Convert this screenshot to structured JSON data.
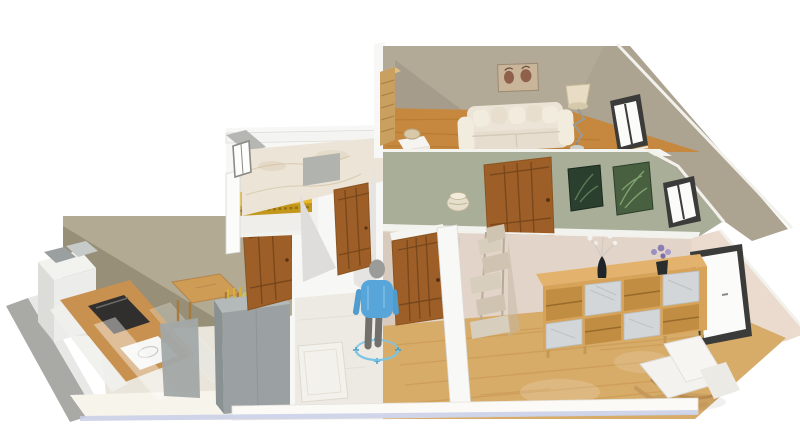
{
  "app": {
    "view": "3d-furnished-floor-plan-render",
    "background": "#ffffff"
  },
  "palette": {
    "lr_wall": "#b3a997",
    "lr_wall_shadow": "#a2988a",
    "right_wall": "#ada391",
    "wood_floor": "#c5883e",
    "wood_streak": "#ad722b",
    "green_wall": "#a8ae97",
    "pink_wall": "#e2d4c8",
    "pink_wall_light": "#eadbce",
    "pink_shadow": "#d6c7ba",
    "oak_floor": "#d7ab68",
    "oak_streak": "#c5944c",
    "door_brown": "#9d5f27",
    "door_line": "#70421a",
    "olive_wall": "#b2aa92",
    "olive_shadow": "#766e59",
    "marble_wall": "#ece4d6",
    "yellow_wall": "#e8b82b",
    "yellow_dark": "#c3961c",
    "gray_cabinet": "#9ba1a2",
    "gray_cabinet_top": "#b4baba",
    "gray_cabinet_side": "#8a9192",
    "counter_wood": "#c89150",
    "oven_dark": "#302f2d",
    "window_frame": "#3b3b39",
    "glass": "#fbfbfa",
    "sofa_cream": "#e6ddcf",
    "sofa_cream_light": "#f2ecdf",
    "sideboard_wood": "#d7a359",
    "sideboard_top": "#e3b26c",
    "marble_panel": "#d2d6d9",
    "cat_tree": "#d8cebd",
    "cat_tree_dark": "#cfc4b1",
    "chair_white": "#f3f2ee",
    "shirt_blue": "#58a5da",
    "pants_gray": "#72706c",
    "head_gray": "#9b9b99",
    "selection_blue": "#7ac5e6",
    "slab_blue": "#c8cee8",
    "art_green_dark": "#2a3f2e",
    "art_green_light": "#48603f",
    "rug_color": "#f3f1eb",
    "hall_floor": "#edeae3",
    "kitchen_floor": "#e9e5da",
    "white_wall": "#f7f7f5"
  },
  "scene": {
    "rooms": [
      {
        "id": "living-room",
        "wall_color": "#b3a997",
        "floor": "wood",
        "furniture": [
          "wardrobe",
          "sofa-with-pillows",
          "wall-art",
          "floor-lamp",
          "side-table-with-basket",
          "window"
        ]
      },
      {
        "id": "middle-bedroom",
        "wall_color": "#a8ae97",
        "furniture": [
          "panel-door",
          "floor-pot",
          "botanical-print-dark",
          "botanical-print-light",
          "window"
        ]
      },
      {
        "id": "bathroom",
        "wall_color": "marble",
        "furniture": [
          "shower-panel",
          "small-window"
        ]
      },
      {
        "id": "yellow-room",
        "wall_color": "#e8b82b",
        "furniture": [
          "tiled-counter"
        ]
      },
      {
        "id": "kitchen",
        "wall_color": "#b2aa92",
        "floor": "tile",
        "furniture": [
          "fridge-unit",
          "cooktop-counter",
          "oven",
          "sink",
          "glass-partition",
          "dining-table",
          "yellow-chair",
          "plant",
          "tall-gray-cabinet",
          "panel-door"
        ]
      },
      {
        "id": "hallway",
        "floor": "marble",
        "furniture": [
          "panel-door",
          "rug",
          "human-figure"
        ]
      },
      {
        "id": "living-dining-room",
        "wall_color": "#e2d4c8",
        "floor": "oak",
        "furniture": [
          "panel-door",
          "cat-tower",
          "sideboard-with-marble-doors",
          "black-vase-white-flowers",
          "purple-flower-pot",
          "lounge-chair",
          "large-window"
        ]
      }
    ],
    "human_figure": {
      "shirt_color": "#58a5da",
      "selected": true
    }
  }
}
